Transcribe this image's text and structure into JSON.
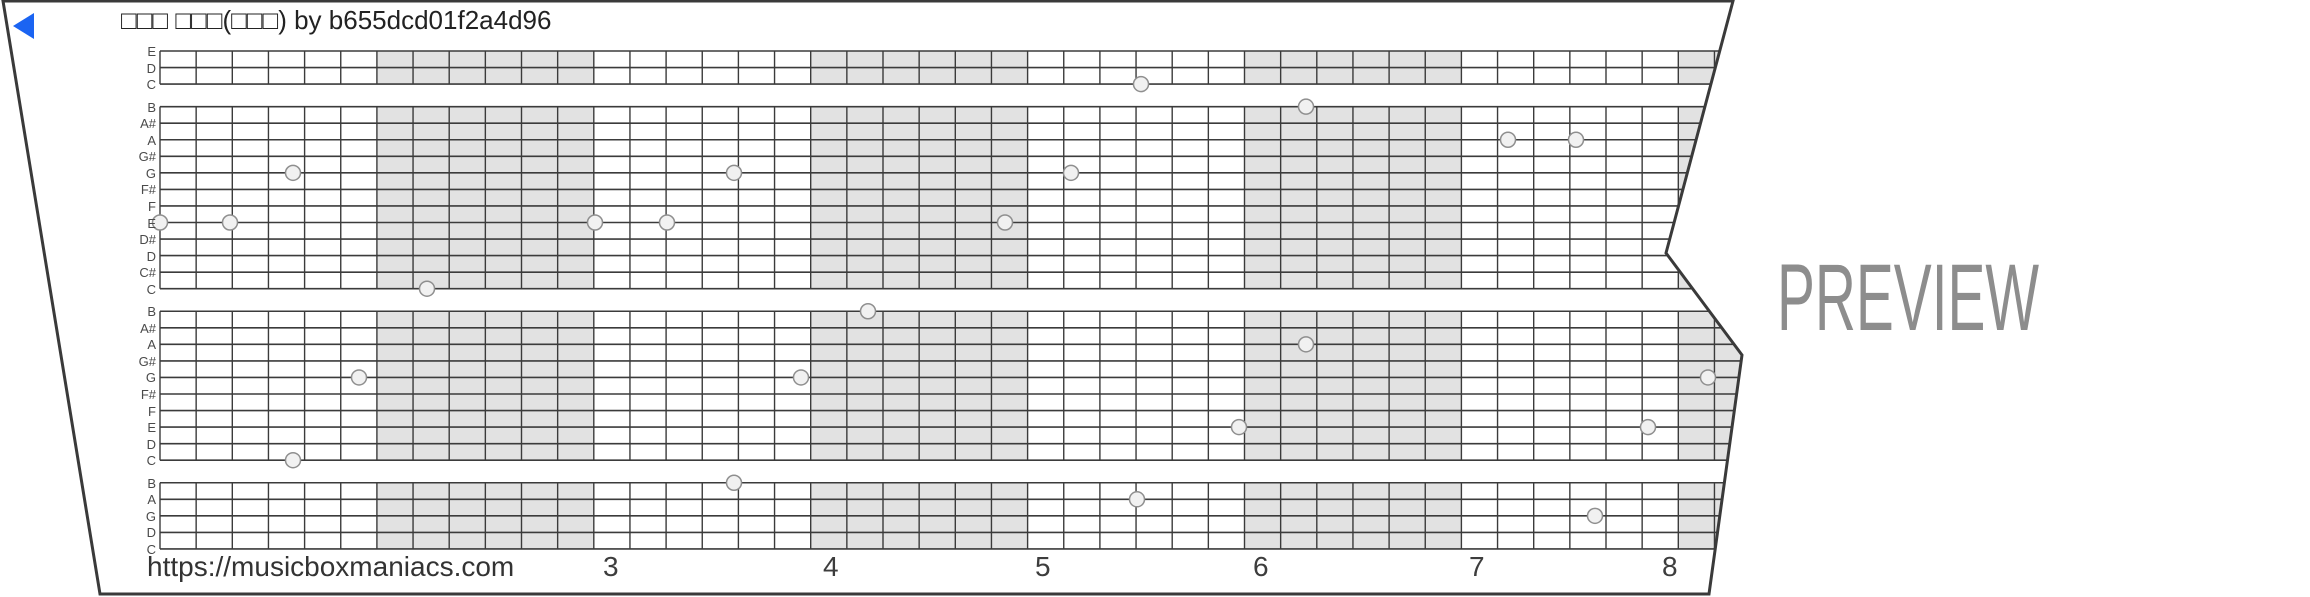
{
  "title": {
    "text": "□□□ □□□(□□□) by b655dcd01f2a4d96"
  },
  "play_button": {
    "color": "#1b64f2"
  },
  "watermark": {
    "text": "PREVIEW",
    "color": "#8d8d8d",
    "x": 1777,
    "baseline_y": 330,
    "font_size": 95,
    "text_length": 262
  },
  "footer": {
    "url": "https://musicboxmaniacs.com",
    "measure_numbers": [
      {
        "label": "3",
        "x": 603
      },
      {
        "label": "4",
        "x": 823
      },
      {
        "label": "5",
        "x": 1035
      },
      {
        "label": "6",
        "x": 1253
      },
      {
        "label": "7",
        "x": 1469
      },
      {
        "label": "8",
        "x": 1662
      }
    ]
  },
  "strip": {
    "paper_color": "#ffffff",
    "edge_color": "#3a3a3a",
    "outline_points": [
      [
        3,
        1
      ],
      [
        1733,
        1
      ],
      [
        1666,
        253
      ],
      [
        1742,
        355
      ],
      [
        1709,
        594
      ],
      [
        100,
        594
      ]
    ],
    "grid": {
      "left": 160,
      "top": 51,
      "right_max": 1750,
      "row_height": 16.55,
      "octave_gap": 6,
      "measure_width": 216.9,
      "cols_per_measure": 6,
      "num_vertical_lines": 45,
      "shaded_measures": [
        2,
        4,
        6,
        8
      ],
      "shade_color": "#e2e2e2",
      "line_color": "#3b3b3b"
    },
    "row_labels": [
      "E",
      "D",
      "C",
      "B",
      "A#",
      "A",
      "G#",
      "G",
      "F#",
      "F",
      "E",
      "D#",
      "D",
      "C#",
      "C",
      "B",
      "A#",
      "A",
      "G#",
      "G",
      "F#",
      "F",
      "E",
      "D",
      "C",
      "B",
      "A",
      "G",
      "D",
      "C"
    ],
    "octave_blocks": [
      [
        0,
        2
      ],
      [
        3,
        14
      ],
      [
        15,
        24
      ],
      [
        25,
        29
      ]
    ],
    "note_style": {
      "radius": 7.5,
      "fill": "#f1f1f1",
      "stroke": "#8f8f8f"
    },
    "notes": [
      {
        "x": 160,
        "row": 10,
        "pitch": "E"
      },
      {
        "x": 230,
        "row": 10,
        "pitch": "E"
      },
      {
        "x": 293,
        "row": 7,
        "pitch": "G"
      },
      {
        "x": 293,
        "row": 24,
        "pitch": "C"
      },
      {
        "x": 359,
        "row": 19,
        "pitch": "G"
      },
      {
        "x": 427,
        "row": 14,
        "pitch": "C"
      },
      {
        "x": 595,
        "row": 10,
        "pitch": "E"
      },
      {
        "x": 667,
        "row": 10,
        "pitch": "E"
      },
      {
        "x": 734,
        "row": 7,
        "pitch": "G"
      },
      {
        "x": 734,
        "row": 25,
        "pitch": "B"
      },
      {
        "x": 801,
        "row": 19,
        "pitch": "G"
      },
      {
        "x": 868,
        "row": 15,
        "pitch": "B"
      },
      {
        "x": 1005,
        "row": 10,
        "pitch": "E"
      },
      {
        "x": 1071,
        "row": 7,
        "pitch": "G"
      },
      {
        "x": 1137,
        "row": 26,
        "pitch": "A"
      },
      {
        "x": 1141,
        "row": 2,
        "pitch": "C"
      },
      {
        "x": 1239,
        "row": 22,
        "pitch": "E"
      },
      {
        "x": 1306,
        "row": 3,
        "pitch": "B"
      },
      {
        "x": 1306,
        "row": 17,
        "pitch": "A"
      },
      {
        "x": 1508,
        "row": 5,
        "pitch": "A"
      },
      {
        "x": 1576,
        "row": 5,
        "pitch": "A"
      },
      {
        "x": 1595,
        "row": 27,
        "pitch": "G"
      },
      {
        "x": 1648,
        "row": 22,
        "pitch": "E"
      },
      {
        "x": 1708,
        "row": 19,
        "pitch": "G"
      }
    ]
  }
}
